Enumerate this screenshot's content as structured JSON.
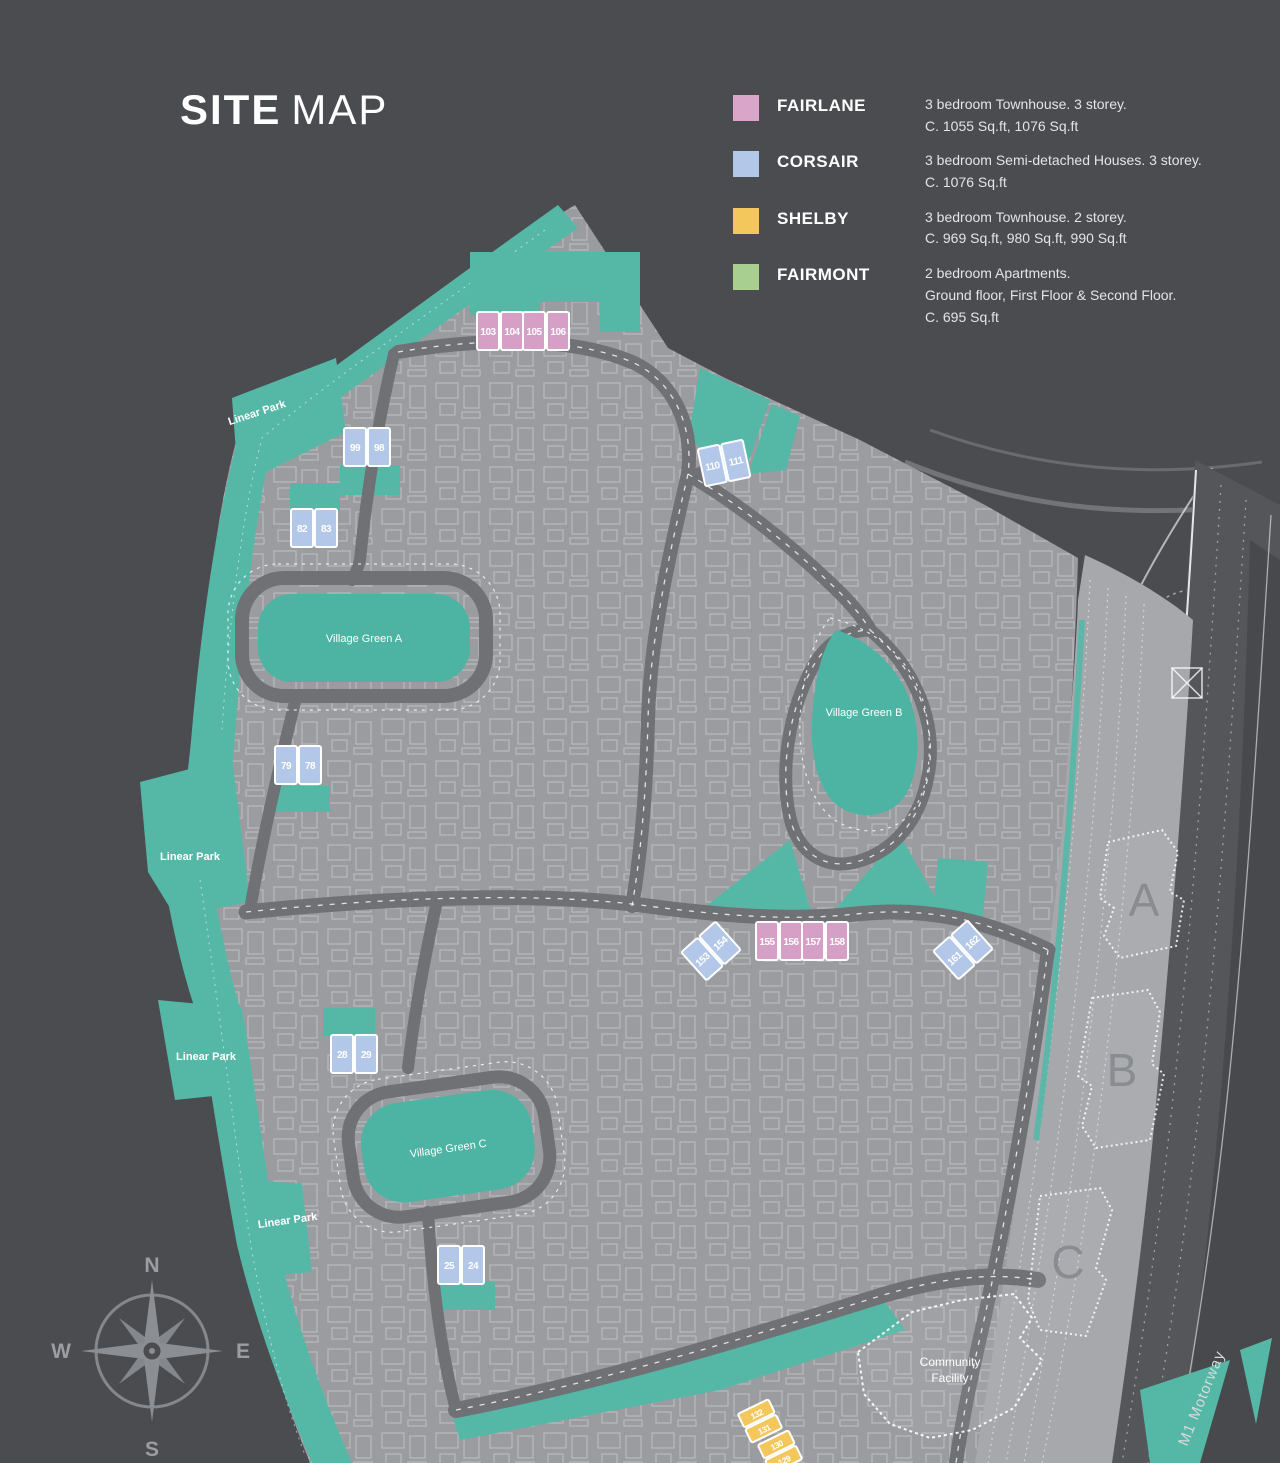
{
  "title": {
    "bold": "SITE",
    "light": "MAP"
  },
  "legend": [
    {
      "name": "FAIRLANE",
      "color": "#d9a6c9",
      "lines": [
        "3 bedroom Townhouse. 3 storey.",
        "C. 1055 Sq.ft, 1076 Sq.ft"
      ]
    },
    {
      "name": "CORSAIR",
      "color": "#b3c8e8",
      "lines": [
        "3 bedroom Semi-detached Houses. 3 storey.",
        "C. 1076 Sq.ft"
      ]
    },
    {
      "name": "SHELBY",
      "color": "#f4c75d",
      "lines": [
        "3 bedroom Townhouse. 2 storey.",
        "C. 969 Sq.ft, 980 Sq.ft, 990 Sq.ft"
      ]
    },
    {
      "name": "FAIRMONT",
      "color": "#a8cf90",
      "lines": [
        "2 bedroom Apartments.",
        "Ground floor, First Floor & Second Floor.",
        "C. 695 Sq.ft"
      ]
    }
  ],
  "map": {
    "village_greens": [
      {
        "label": "Village Green A"
      },
      {
        "label": "Village Green B"
      },
      {
        "label": "Village Green C"
      }
    ],
    "linear_park_labels": [
      {
        "text": "Linear Park"
      },
      {
        "text": "Linear Park"
      },
      {
        "text": "Linear Park"
      },
      {
        "text": "Linear Park"
      }
    ],
    "plots": [
      {
        "type": "fairlane",
        "numbers": [
          "103",
          "104"
        ]
      },
      {
        "type": "fairlane",
        "numbers": [
          "105",
          "106"
        ]
      },
      {
        "type": "corsair",
        "numbers": [
          "99",
          "98"
        ]
      },
      {
        "type": "corsair",
        "numbers": [
          "82",
          "83"
        ]
      },
      {
        "type": "corsair",
        "numbers": [
          "110",
          "111"
        ]
      },
      {
        "type": "corsair",
        "numbers": [
          "79",
          "78"
        ]
      },
      {
        "type": "fairlane",
        "numbers": [
          "155",
          "156"
        ]
      },
      {
        "type": "fairlane",
        "numbers": [
          "157",
          "158"
        ]
      },
      {
        "type": "corsair",
        "numbers": [
          "153",
          "154"
        ]
      },
      {
        "type": "corsair",
        "numbers": [
          "161",
          "162"
        ]
      },
      {
        "type": "corsair",
        "numbers": [
          "28",
          "29"
        ]
      },
      {
        "type": "corsair",
        "numbers": [
          "25",
          "24"
        ]
      },
      {
        "type": "shelby",
        "numbers": [
          "132",
          "131"
        ]
      },
      {
        "type": "shelby",
        "numbers": [
          "130",
          "129"
        ]
      }
    ],
    "buildings": [
      {
        "label": "A"
      },
      {
        "label": "B"
      },
      {
        "label": "C"
      }
    ],
    "community_facility": {
      "line1": "Community",
      "line2": "Facility"
    },
    "motorway_label": "M1 Motorway",
    "compass": {
      "n": "N",
      "e": "E",
      "s": "S",
      "w": "W"
    }
  },
  "colors": {
    "background": "#4a4c50",
    "site": "#9a9ca0",
    "road": "#6f7175",
    "park": "#55b8a7",
    "village_green": "#4db3a2",
    "motorway": "#54565a",
    "building_strip": "#a6a8ab"
  }
}
